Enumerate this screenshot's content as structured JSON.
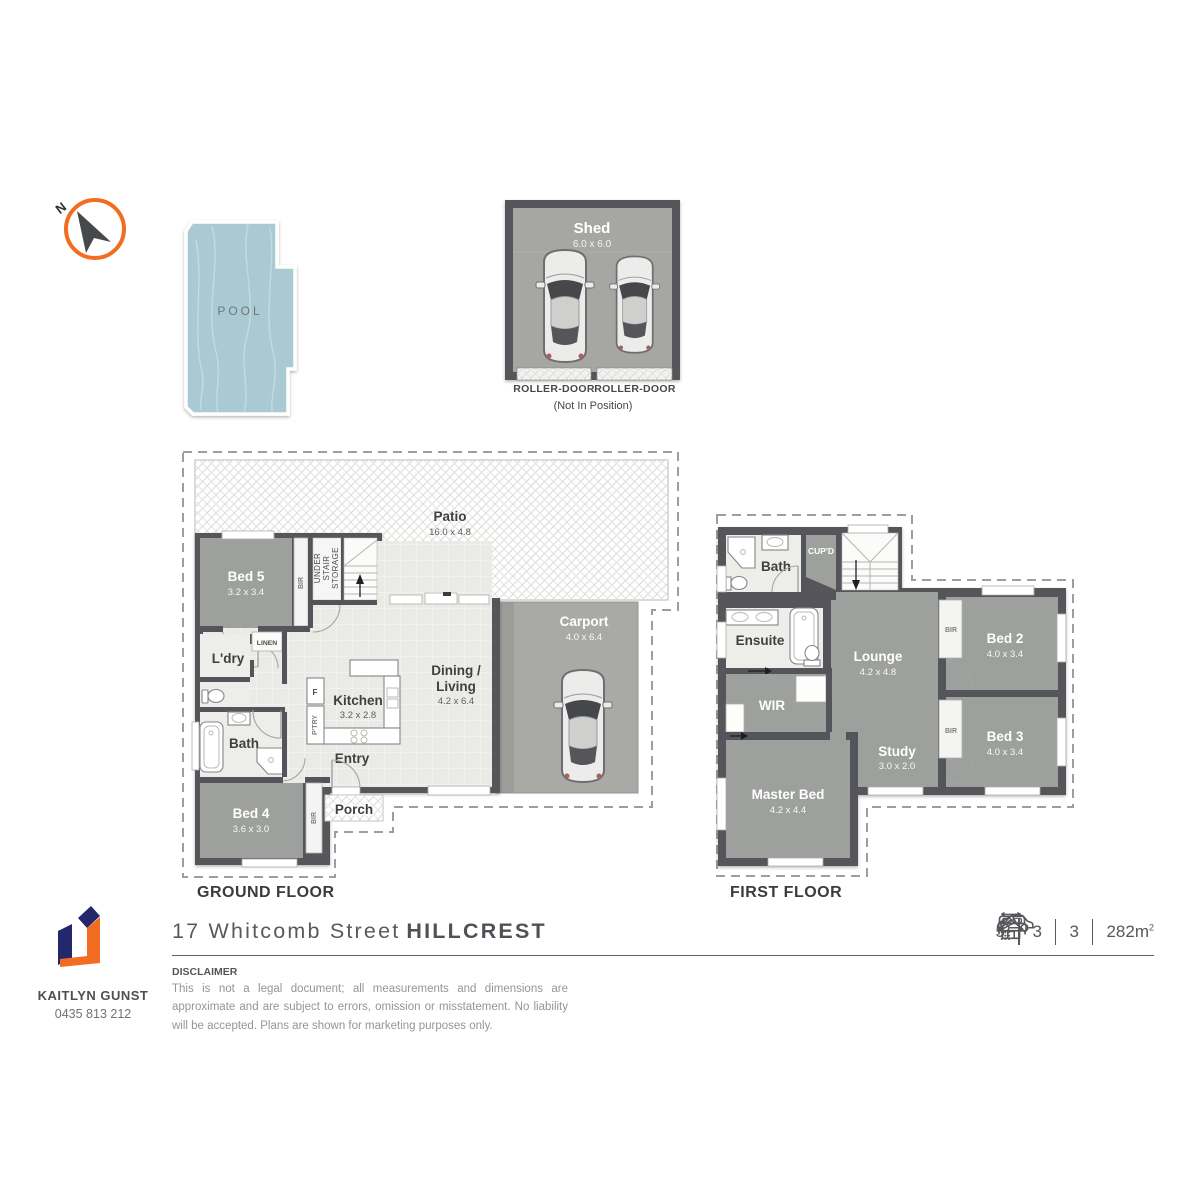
{
  "colors": {
    "accent_orange": "#F26C21",
    "navy": "#23276B",
    "wall_gray": "#54555A",
    "room_gray": "#9DA09C",
    "floor_light": "#EAEAE6",
    "concrete": "#A9A9A5",
    "pool_blue": "#A9CAD2"
  },
  "compass": {
    "north": "N"
  },
  "pool": {
    "label": "POOL"
  },
  "shed": {
    "name": "Shed",
    "dims": "6.0 x 6.0",
    "roller_left": "ROLLER-DOOR",
    "roller_right": "ROLLER-DOOR",
    "note": "(Not In Position)"
  },
  "ground": {
    "title": "GROUND FLOOR",
    "patio": {
      "name": "Patio",
      "dims": "16.0 x 4.8"
    },
    "bed5": {
      "name": "Bed 5",
      "dims": "3.2 x 3.4"
    },
    "bed4": {
      "name": "Bed 4",
      "dims": "3.6 x 3.0"
    },
    "kitchen": {
      "name": "Kitchen",
      "dims": "3.2 x 2.8"
    },
    "dining": {
      "line1": "Dining /",
      "line2": "Living",
      "dims": "4.2 x 6.4"
    },
    "carport": {
      "name": "Carport",
      "dims": "4.0 x 6.4"
    },
    "laundry": "L'dry",
    "linen": "LINEN",
    "bath": "Bath",
    "entry": "Entry",
    "porch": "Porch",
    "fridge": "F",
    "pantry": "P'TRY",
    "bir_bed5": "BIR",
    "bir_bed4": "BIR",
    "understair": {
      "l1": "UNDER",
      "l2": "STAIR",
      "l3": "STORAGE"
    }
  },
  "first": {
    "title": "FIRST FLOOR",
    "bath": "Bath",
    "cupd": "CUP'D",
    "ensuite": "Ensuite",
    "wir": "WIR",
    "lounge": {
      "name": "Lounge",
      "dims": "4.2 x 4.8"
    },
    "bed2": {
      "name": "Bed 2",
      "dims": "4.0 x 3.4"
    },
    "bed3": {
      "name": "Bed 3",
      "dims": "4.0 x 3.4"
    },
    "study": {
      "name": "Study",
      "dims": "3.0 x 2.0"
    },
    "master": {
      "name": "Master Bed",
      "dims": "4.2 x 4.4"
    },
    "bir_bed2": "BIR",
    "bir_bed3": "BIR"
  },
  "footer": {
    "agent_name": "KAITLYN GUNST",
    "agent_phone": "0435 813 212",
    "address_street": "17 Whitcomb Street",
    "address_suburb": "HILLCREST",
    "features": {
      "beds": "5",
      "showers": "3",
      "cars": "3",
      "area": "282m",
      "area_exp": "2"
    },
    "disclaimer_heading": "DISCLAIMER",
    "disclaimer_text": "This is not a legal document; all measurements and dimensions are approximate and are subject to errors, omission or misstatement. No liability will be accepted. Plans are shown for marketing purposes only."
  }
}
